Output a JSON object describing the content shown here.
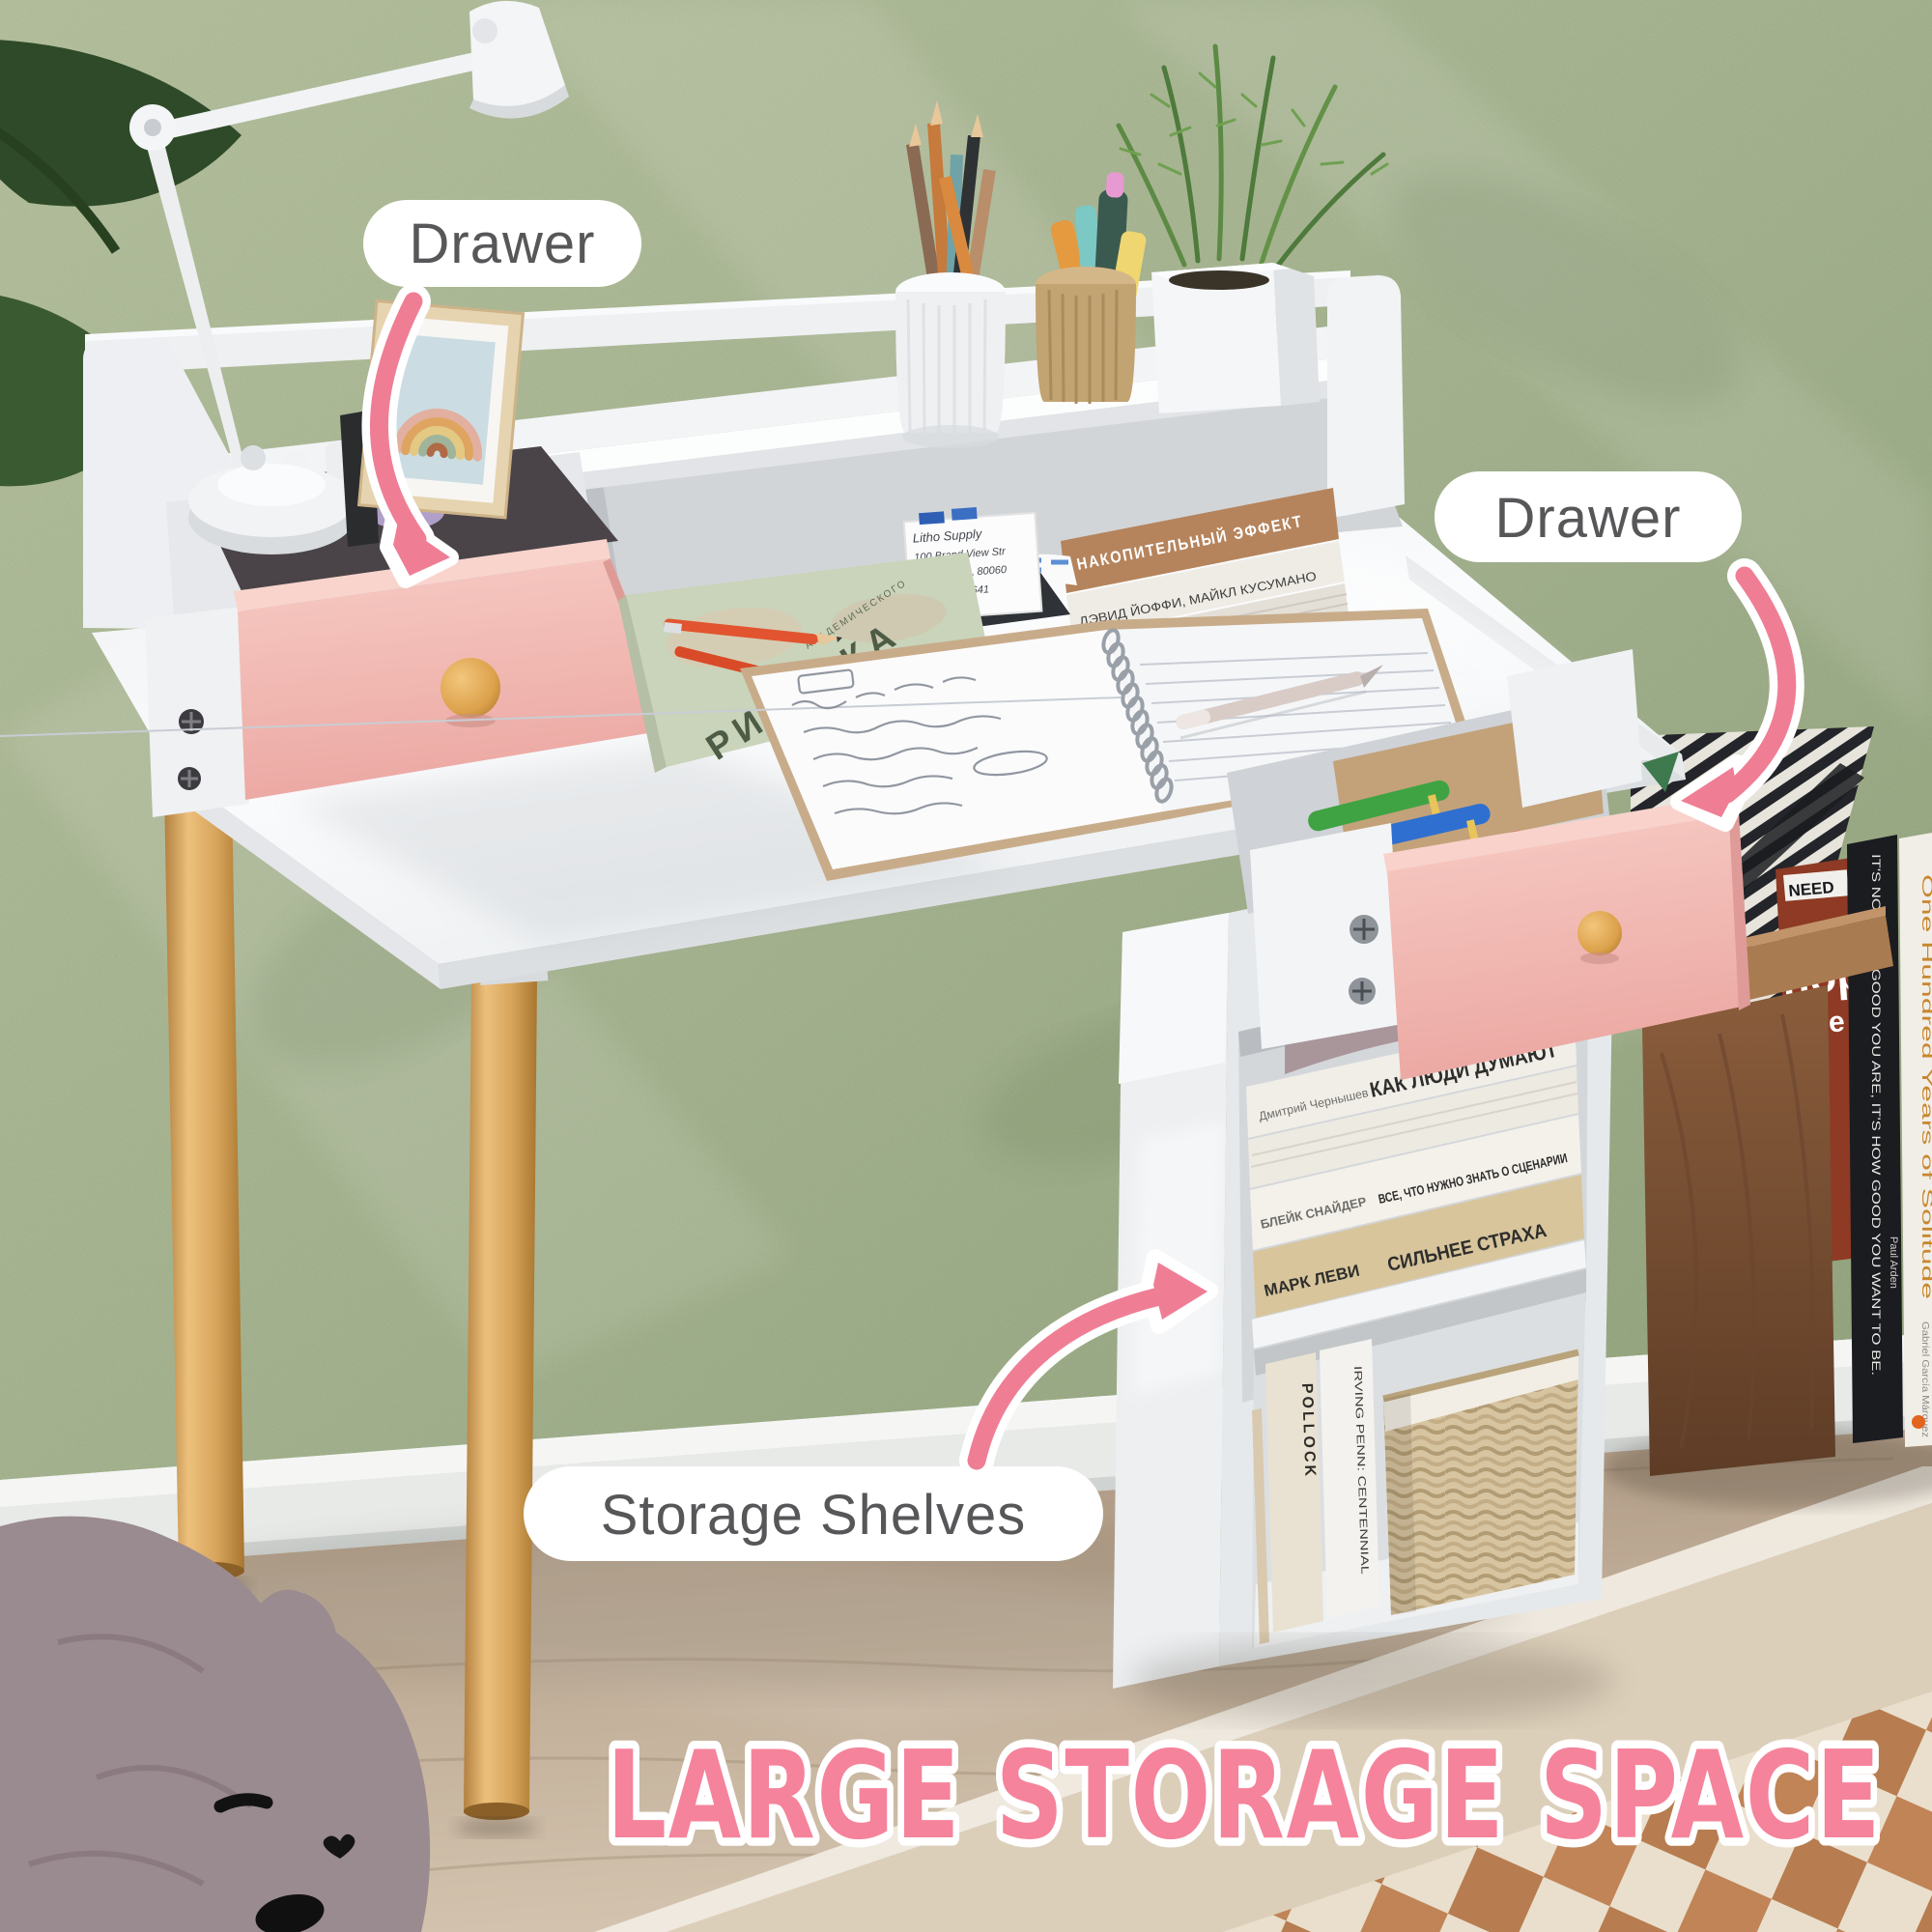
{
  "callouts": {
    "drawer_left": {
      "label": "Drawer"
    },
    "drawer_right": {
      "label": "Drawer"
    },
    "storage_shelves": {
      "label": "Storage Shelves"
    }
  },
  "headline": {
    "text": "LARGE STORAGE SPACE",
    "fill": "#F5839B",
    "outline": "#FFFFFF"
  },
  "colors": {
    "wall_green": "#AFC098",
    "accent_pink_arrow": "#EF7E95",
    "drawer_pink": "#F2BEB8",
    "callout_text": "#57575A",
    "wood_leg": "#D9A662",
    "knob_wood": "#DFA64F",
    "rug_terracotta": "#C08457",
    "rug_cream": "#E9DFCC"
  },
  "desk": {
    "desktop_books": {
      "top_book": {
        "title": "НАКОПИТЕЛЬНЫЙ ЭФФЕКТ",
        "author": "Марк Гоулстон"
      },
      "second_book": {
        "authors": "ДЭВИД ЙОФФИ, МАЙКЛ КУСУМАНО"
      }
    },
    "art_book": {
      "title": "РИСУНКА",
      "series": "АКАДЕМИЧЕСКОГО"
    },
    "memo_card": {
      "line1": "Litho Supply",
      "line2": "100 Brand View Str",
      "line3": "Wheeling, IL 80060",
      "line4": "(941) 667-4641"
    }
  },
  "pedestal_shelf_books": {
    "book1": {
      "author": "Дмитрий Чернышев",
      "title": "КАК ЛЮДИ ДУМАЮТ"
    },
    "book2": {
      "author": "БЛЕЙК СНАЙДЕР",
      "title": "ВСЕ, ЧТО НУЖНО ЗНАТЬ О СЦЕНАРИИ"
    },
    "book3": {
      "author": "МАРК ЛЕВИ",
      "title": "СИЛЬНЕЕ СТРАХА"
    }
  },
  "bottom_shelf_books": {
    "book1": "POLLOCK",
    "book2": "IRVING PENN: CENTENNIAL"
  },
  "side_shelf_books": {
    "magazine_badge": "NEED",
    "magazine_line1": "nop",
    "magazine_line2": "ative",
    "black_book_title": "IT'S NOT HOW GOOD YOU ARE, IT'S HOW GOOD YOU WANT TO BE.",
    "black_book_author": "Paul Arden",
    "novel_title": "One Hundred Years of Solitude",
    "novel_author": "Gabriel García Márquez"
  }
}
